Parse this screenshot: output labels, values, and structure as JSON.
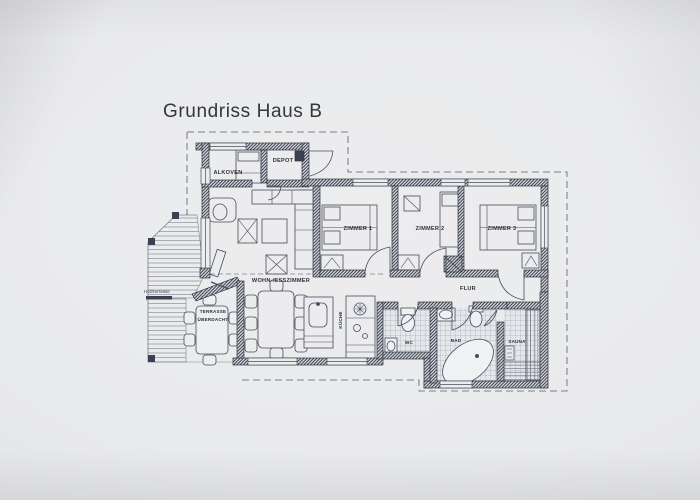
{
  "photo": {
    "title": "Grundriss Haus B"
  },
  "rooms": {
    "alkoven": "ALKOVEN",
    "depot": "DEPOT",
    "zimmer1": "ZIMMER 1",
    "zimmer2": "ZIMMER 2",
    "zimmer3": "ZIMMER 3",
    "flur": "FLUR",
    "wohn_esszimmer": "WOHN-/ESSZIMMER",
    "kueche": "KÜCHE",
    "wc": "WC",
    "bad": "BAD",
    "sauna": "SAUNA",
    "terrasse_zeile1": "TERRASSE",
    "terrasse_zeile2": "ÜBERDACHT",
    "holzterrasse": "Holzterrasse"
  },
  "colors": {
    "ink": "#3a4150",
    "paper": "#e9eaec",
    "tile_line": "#8f95a2",
    "deck_line": "#8a8f9b"
  }
}
